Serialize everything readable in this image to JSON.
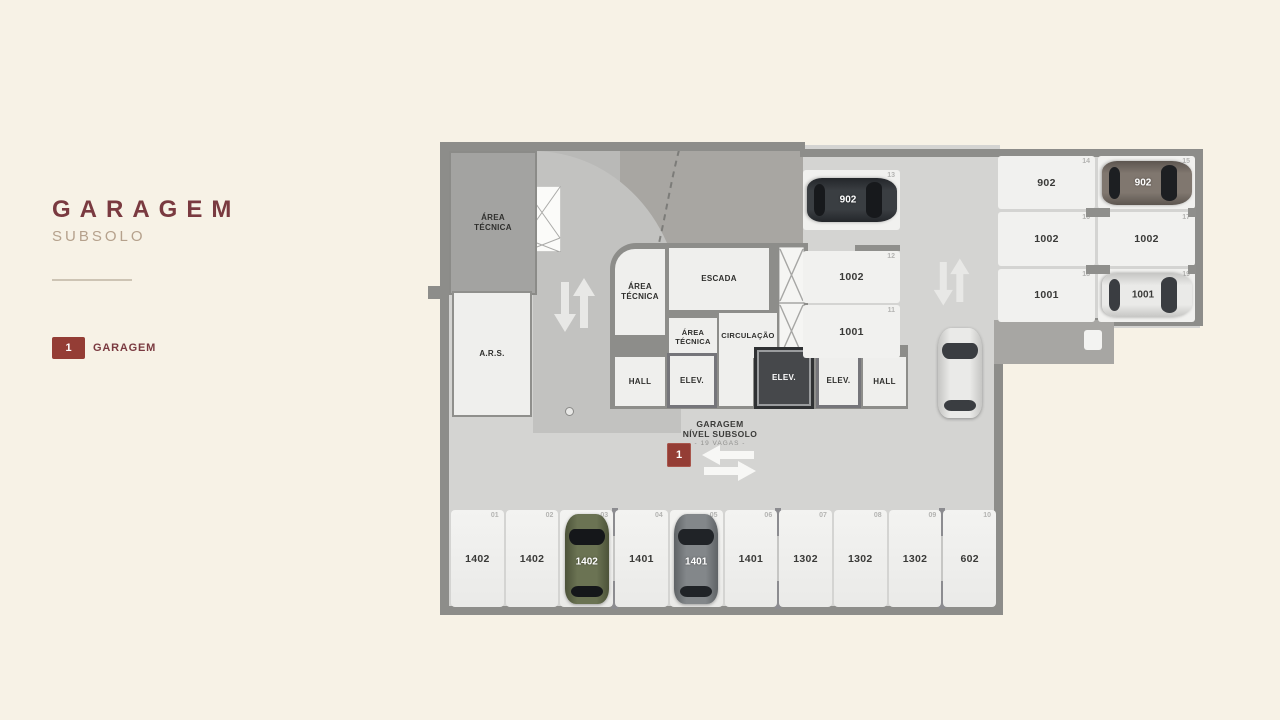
{
  "panel": {
    "title": "GARAGEM",
    "subtitle": "SUBSOLO",
    "legend_badge": "1",
    "legend_label": "GARAGEM"
  },
  "plan": {
    "labels": {
      "area_tecnica": "ÁREA TÉCNICA",
      "ars": "A.R.S.",
      "escada": "ESCADA",
      "circulacao": "CIRCULAÇÃO",
      "hall": "HALL",
      "elev": "ELEV."
    },
    "center": {
      "line1": "GARAGEM",
      "line2": "NÍVEL SUBSOLO",
      "line3": "- 19 VAGAS -",
      "badge": "1"
    },
    "spots": {
      "bottom_row": [
        {
          "num": "01",
          "label": "1402"
        },
        {
          "num": "02",
          "label": "1402"
        },
        {
          "num": "03",
          "label": "1402",
          "car": {
            "color": "green",
            "label": "1402"
          }
        },
        {
          "num": "04",
          "label": "1401"
        },
        {
          "num": "05",
          "label": "1401",
          "car": {
            "color": "gray",
            "label": "1401"
          }
        },
        {
          "num": "06",
          "label": "1401"
        },
        {
          "num": "07",
          "label": "1302"
        },
        {
          "num": "08",
          "label": "1302"
        },
        {
          "num": "09",
          "label": "1302"
        },
        {
          "num": "10",
          "label": "602"
        }
      ],
      "mid_column": [
        {
          "num": "13",
          "label": "902",
          "car": {
            "color": "dark",
            "label": "902",
            "orient": "h"
          }
        },
        {
          "num": "12",
          "label": "1002"
        },
        {
          "num": "11",
          "label": "1001"
        }
      ],
      "right_block": [
        {
          "num": "14",
          "label": "902"
        },
        {
          "num": "15",
          "label": "902",
          "car": {
            "color": "brown",
            "label": "902",
            "orient": "h"
          }
        },
        {
          "num": "16",
          "label": "1002"
        },
        {
          "num": "17",
          "label": "1002"
        },
        {
          "num": "18",
          "label": "1001"
        },
        {
          "num": "19",
          "label": "1001",
          "car": {
            "color": "white",
            "label": "1001",
            "orient": "h"
          }
        }
      ]
    }
  },
  "colors": {
    "bg": "#f7f2e6",
    "accent": "#943d35",
    "title_maroon": "#7a3a40",
    "subtitle_tan": "#b5a18c",
    "wall": "#8d8d8a",
    "floor": "#d4d4d2",
    "ramp": "#c2c2c0",
    "dark_zone": "#a8a6a2",
    "room_gray": "#a3a3a1",
    "room_white": "#efefed",
    "spot": "#f1f1ef",
    "car_dark": "#3a3e42",
    "car_brown": "#80776f",
    "car_white": "#eaeae8",
    "car_green": "#6b7353",
    "car_gray": "#83878a"
  }
}
